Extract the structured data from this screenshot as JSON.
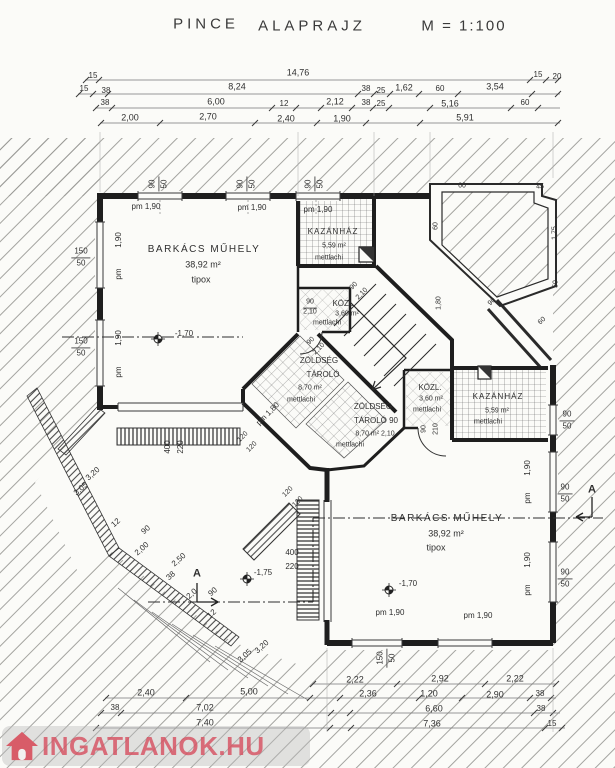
{
  "title": {
    "left": "PINCE",
    "center": "ALAPRAJZ",
    "scale": "M = 1:100"
  },
  "rooms": {
    "barkacs_upper": {
      "name": "BARKÁCS MŰHELY",
      "area": "38,92 m²",
      "floor": "tipox"
    },
    "barkacs_lower": {
      "name": "BARKÁCS MŰHELY",
      "area": "38,92 m²",
      "floor": "tipox"
    },
    "kazanhaz_upper": {
      "name": "KAZÁNHÁZ",
      "area": "5,59 m²",
      "floor": "mettlachi"
    },
    "kazanhaz_lower": {
      "name": "KAZÁNHÁZ",
      "area": "5,59 m²",
      "floor": "mettlachi"
    },
    "kozl_upper": {
      "name": "KÖZL.",
      "area": "3,60 m²",
      "floor": "mettlachi"
    },
    "kozl_lower": {
      "name": "KÖZL.",
      "area": "3,60 m²",
      "floor": "mettlachi"
    },
    "zoldseg_upper": {
      "name1": "ZÖLDSÉG",
      "name2": "TÁROLÓ",
      "area": "8,70 m²",
      "floor": "mettlachi"
    },
    "zoldseg_lower": {
      "name1": "ZÖLDSÉG",
      "name2": "TÁROLÓ 90",
      "area": "8,70 m² 2,10",
      "floor": "mettlachi"
    }
  },
  "levels": {
    "upper_room": "-1,70",
    "lower_room": "-1,70",
    "courtyard": "-1,75"
  },
  "dims": {
    "top1": [
      "15",
      "14,76",
      "15",
      "20"
    ],
    "top2": [
      "15",
      "38",
      "8,24",
      "38",
      "25",
      "1,62",
      "60",
      "3,54"
    ],
    "top3": [
      "38",
      "6,00",
      "12",
      "2,12",
      "38",
      "25",
      "5,16",
      "60"
    ],
    "top4": [
      "2,00",
      "2,70",
      "2,40",
      "1,90",
      "5,91"
    ],
    "bot1": [
      "2,22",
      "2,92",
      "2,22"
    ],
    "bot2": [
      "2,40",
      "5,00",
      "2,36",
      "1,20",
      "2,90",
      "38"
    ],
    "bot3": [
      "38",
      "7,02",
      "6,60",
      "38"
    ],
    "bot4": [
      "7,40",
      "7,36",
      "15"
    ],
    "diag_left": [
      "3,20",
      "3,05"
    ],
    "diag_bottom": [
      "3,20",
      "3,05"
    ],
    "diag_chain": [
      "12",
      "90",
      "2,00",
      "2,50",
      "38",
      "2,0",
      "90",
      "12"
    ],
    "upper_right": [
      "60",
      "45",
      "60",
      "1,75",
      "50",
      "90",
      "1,80",
      "60"
    ]
  },
  "openings": {
    "w90": "90",
    "w50": "50",
    "w150": "150",
    "h190": "1,90",
    "pm": "pm",
    "pm190": "pm 1,90",
    "pm180": "pm 1,80",
    "door_w": "90",
    "door_h": "2,10",
    "door_hv": "210",
    "g400": "400",
    "g220": "220",
    "lw120": "120"
  },
  "section": {
    "label": "A"
  },
  "watermark": {
    "text": "INGATLANOK.HU"
  }
}
